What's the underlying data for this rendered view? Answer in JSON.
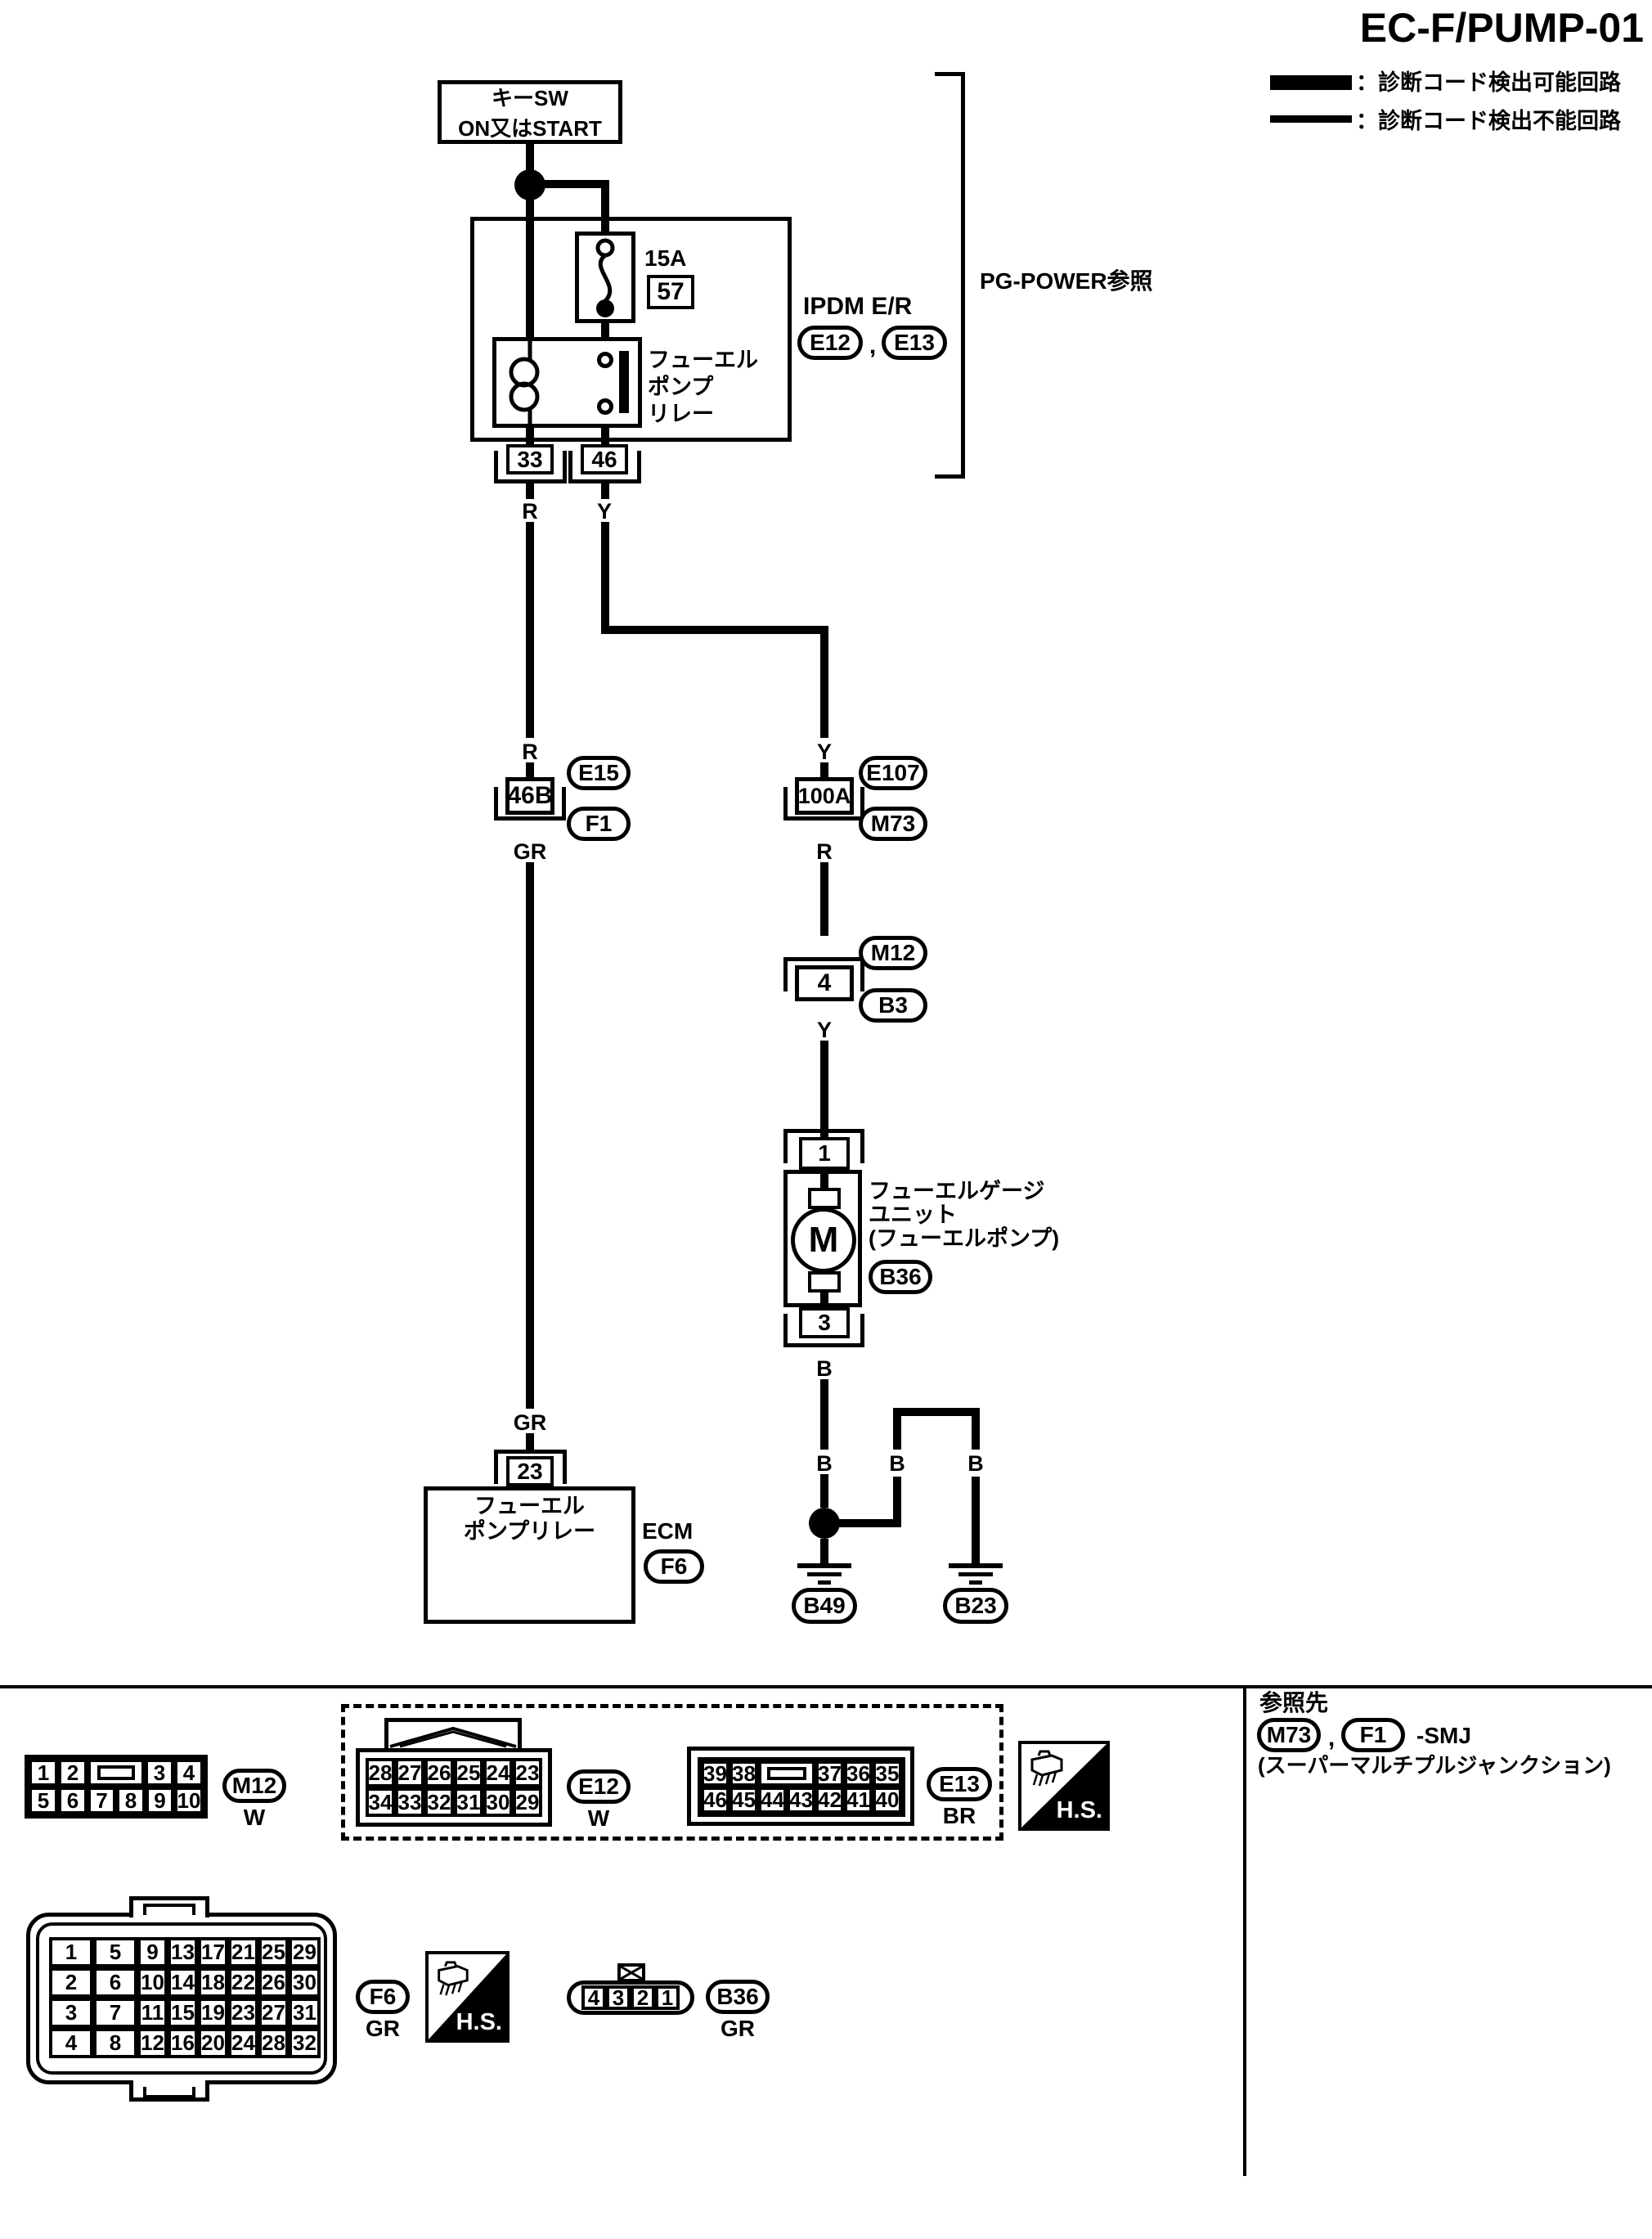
{
  "title": "EC-F/PUMP-01",
  "legend": {
    "detectable": "：診断コード検出可能回路",
    "undetectable": "：診断コード検出不能回路"
  },
  "power_source": {
    "line1": "キーSW",
    "line2": "ON又はSTART"
  },
  "wires": {
    "r": "R",
    "y": "Y",
    "gr": "GR",
    "b": "B"
  },
  "ipdm": {
    "fuse_rating": "15A",
    "fuse_number": "57",
    "relay_name_l1": "フューエル",
    "relay_name_l2": "ポンプ",
    "relay_name_l3": "リレー",
    "unit_name": "IPDM E/R",
    "connector_a": "E12",
    "comma": ",",
    "connector_b": "E13",
    "ref_note": "PG-POWER参照",
    "pin_left": "33",
    "pin_right": "46"
  },
  "smj_left": {
    "pin": "46B",
    "top_conn": "E15",
    "bottom_conn": "F1"
  },
  "smj_right": {
    "pin": "100A",
    "top_conn": "E107",
    "bottom_conn": "M73"
  },
  "joint": {
    "pin": "4",
    "top_conn": "M12",
    "bottom_conn": "B3"
  },
  "fuel_gauge": {
    "pin_top": "1",
    "pin_bottom": "3",
    "motor": "M",
    "name_l1": "フューエルゲージ",
    "name_l2": "ユニット",
    "name_l3": "(フューエルポンプ)",
    "connector": "B36"
  },
  "ecm": {
    "pin": "23",
    "name_l1": "フューエル",
    "name_l2": "ポンプリレー",
    "label": "ECM",
    "connector": "F6"
  },
  "grounds": {
    "left": "B49",
    "right": "B23"
  },
  "footer": {
    "hs": "H.S.",
    "m12": {
      "label": "M12",
      "color": "W",
      "row1": [
        "1",
        "2",
        "3",
        "4"
      ],
      "row2": [
        "5",
        "6",
        "7",
        "8",
        "9",
        "10"
      ]
    },
    "e12": {
      "label": "E12",
      "color": "W",
      "row1": [
        "28",
        "27",
        "26",
        "25",
        "24",
        "23"
      ],
      "row2": [
        "34",
        "33",
        "32",
        "31",
        "30",
        "29"
      ]
    },
    "e13": {
      "label": "E13",
      "color": "BR",
      "row1": [
        "39",
        "38",
        "37",
        "36",
        "35"
      ],
      "row2": [
        "46",
        "45",
        "44",
        "43",
        "42",
        "41",
        "40"
      ]
    },
    "f6": {
      "label": "F6",
      "color": "GR",
      "row1": [
        "1",
        "5",
        "9",
        "13",
        "17",
        "21",
        "25",
        "29"
      ],
      "row2": [
        "2",
        "6",
        "10",
        "14",
        "18",
        "22",
        "26",
        "30"
      ],
      "row3": [
        "3",
        "7",
        "11",
        "15",
        "19",
        "23",
        "27",
        "31"
      ],
      "row4": [
        "4",
        "8",
        "12",
        "16",
        "20",
        "24",
        "28",
        "32"
      ]
    },
    "b36": {
      "label": "B36",
      "color": "GR",
      "pins": [
        "4",
        "3",
        "2",
        "1"
      ]
    },
    "ref": {
      "heading": "参照先",
      "conn1": "M73",
      "comma": ",",
      "conn2": "F1",
      "suffix": "-SMJ",
      "note": "(スーパーマルチプルジャンクション)"
    }
  }
}
